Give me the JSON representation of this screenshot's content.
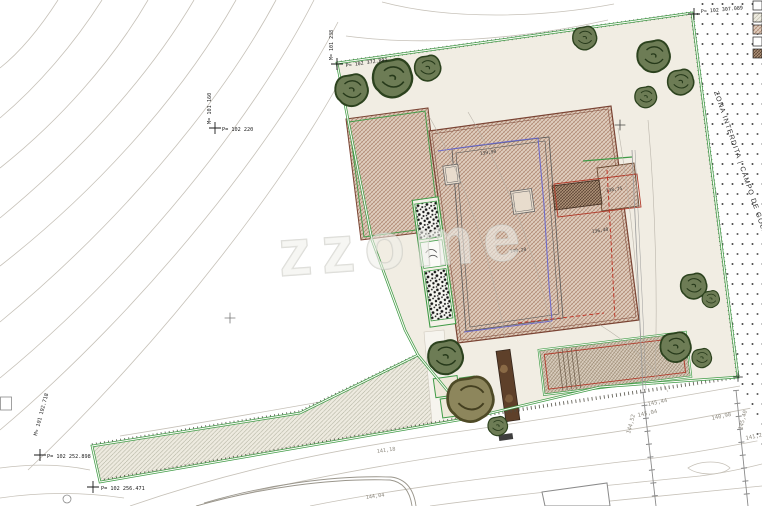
{
  "drawing": {
    "watermark": "zzome",
    "golf_zone_label": "ZONA INTERDITA | CAMPO DE GOLF"
  },
  "survey_points": {
    "left_outer": {
      "m": "M= 101 160",
      "p": "P= 102 220"
    },
    "plot_top_left": {
      "m": "M= 101 238",
      "p": "P= 102 372.891"
    },
    "plot_top_right": {
      "p": "P= 102 307.089"
    },
    "road_axis": {
      "m": "M= 101 192.718"
    },
    "bottom_a": {
      "p": "P= 102 252.898"
    },
    "bottom_b": {
      "p": "P= 102 256.471"
    }
  },
  "elevation_labels": {
    "e1": "145,44",
    "e2": "145,04",
    "e3": "144,52",
    "e4": "145,40",
    "e5": "141,21",
    "e6": "140,98",
    "e7": "144,04",
    "e8": "141,18"
  },
  "spot_elevations": {
    "s1": "139,90",
    "s2": "138,75",
    "s3": "136,40",
    "s4": "140,20"
  },
  "colors": {
    "boundary_green": "#3f9b46",
    "roof_tan": "#decdbd",
    "roof_line": "#7a4434",
    "accent_red": "#b03a2a",
    "pool_blue": "#6565cf",
    "contour_gray": "#c6c1b8"
  }
}
